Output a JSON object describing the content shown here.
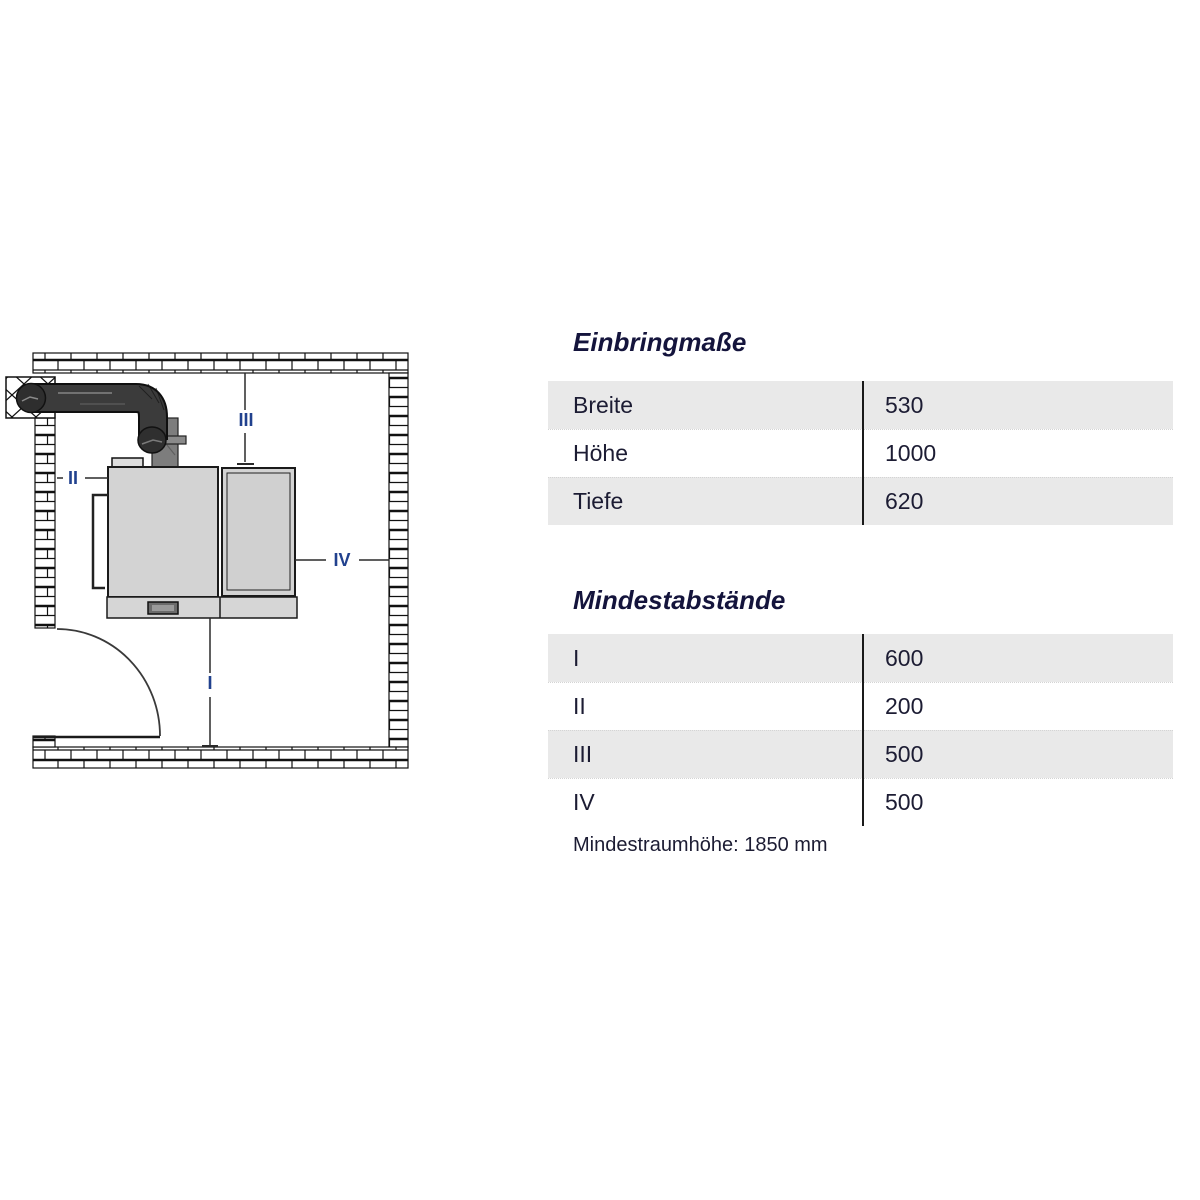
{
  "page": {
    "background": "#ffffff",
    "kind": "boiler installation dimensions sheet"
  },
  "colors": {
    "row_gray": "#e9e9e9",
    "table_divider": "#1a1a1a",
    "title_text": "#14143c",
    "body_text": "#1c1c33",
    "diagram_label_blue": "#21418e",
    "pipe_dark": "#3b3b3b",
    "boiler_gray": "#d3d3d3"
  },
  "diagram": {
    "description": "room plan with chimney, flue pipe, boiler, door swing and minimum-distance dimension lines",
    "labels": {
      "i": "I",
      "ii": "II",
      "iii": "III",
      "iv": "IV"
    }
  },
  "tables": [
    {
      "title": "Einbringmaße",
      "rows": [
        {
          "label": "Breite",
          "value": "530"
        },
        {
          "label": "Höhe",
          "value": "1000"
        },
        {
          "label": "Tiefe",
          "value": "620"
        }
      ]
    },
    {
      "title": "Mindestabstände",
      "rows": [
        {
          "label": "I",
          "value": "600"
        },
        {
          "label": "II",
          "value": "200"
        },
        {
          "label": "III",
          "value": "500"
        },
        {
          "label": "IV",
          "value": "500"
        }
      ]
    }
  ],
  "footnote": "Mindestraumhöhe: 1850 mm"
}
